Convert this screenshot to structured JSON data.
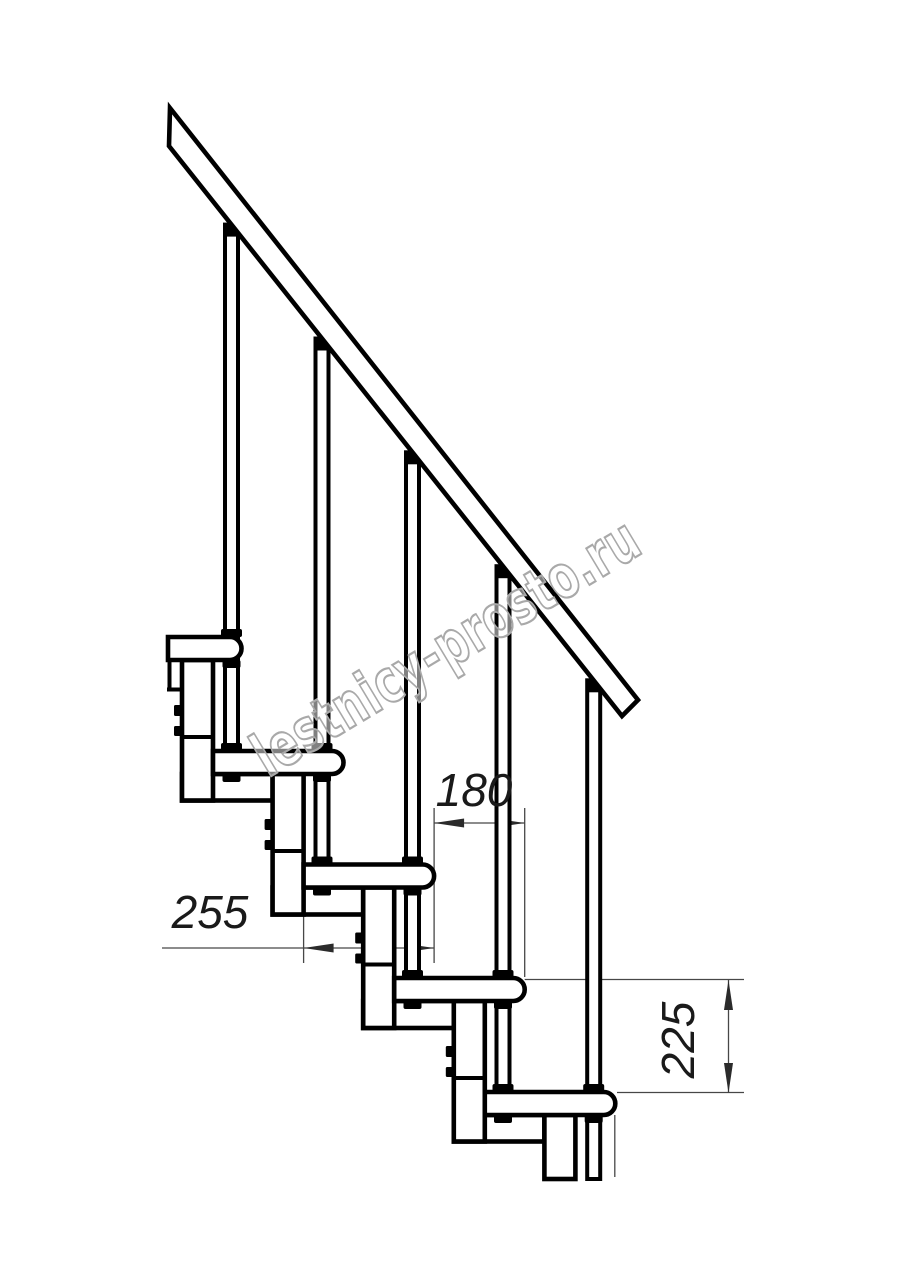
{
  "drawing": {
    "type": "technical-drawing",
    "subject": "modular-staircase-side-elevation",
    "watermark": "lestnicy-prosto.ru",
    "dimensions": {
      "step_run": "180",
      "tread_depth": "255",
      "step_rise": "225"
    },
    "stair": {
      "treads_visible": 5,
      "balusters_visible": 5,
      "handrail": "diagonal"
    },
    "colors": {
      "background": "#ffffff",
      "main_line": "#000000",
      "dimension_line": "#474747",
      "watermark": "#a9a9a9"
    }
  }
}
